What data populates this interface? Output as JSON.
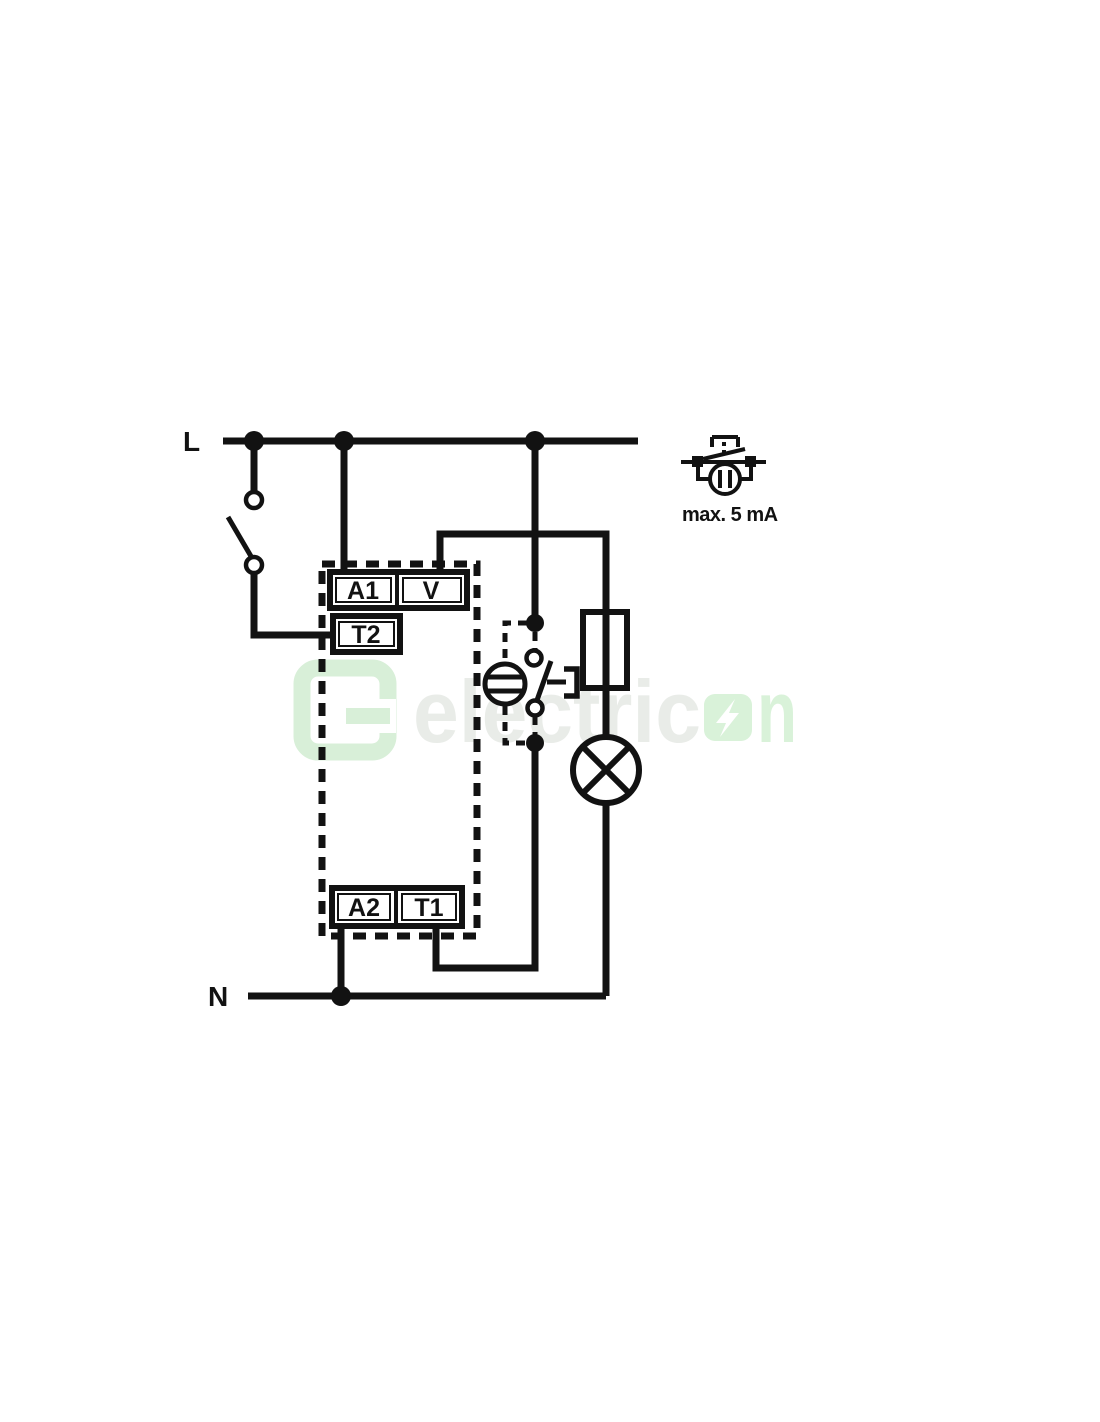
{
  "colors": {
    "line": "#121212",
    "background": "#ffffff",
    "watermark_gray": "#e9ece8",
    "watermark_green": "#d9f2d9",
    "watermark_logo": "#d8efd8",
    "watermark_bolt": "#ffffff"
  },
  "power": {
    "live_label": "L",
    "neutral_label": "N"
  },
  "terminals": {
    "a1": "A1",
    "v": "V",
    "t2": "T2",
    "a2": "A2",
    "t1": "T1"
  },
  "legend": {
    "caption": "max. 5 mA"
  },
  "watermark": {
    "text_left": "electric",
    "text_right": "n"
  }
}
